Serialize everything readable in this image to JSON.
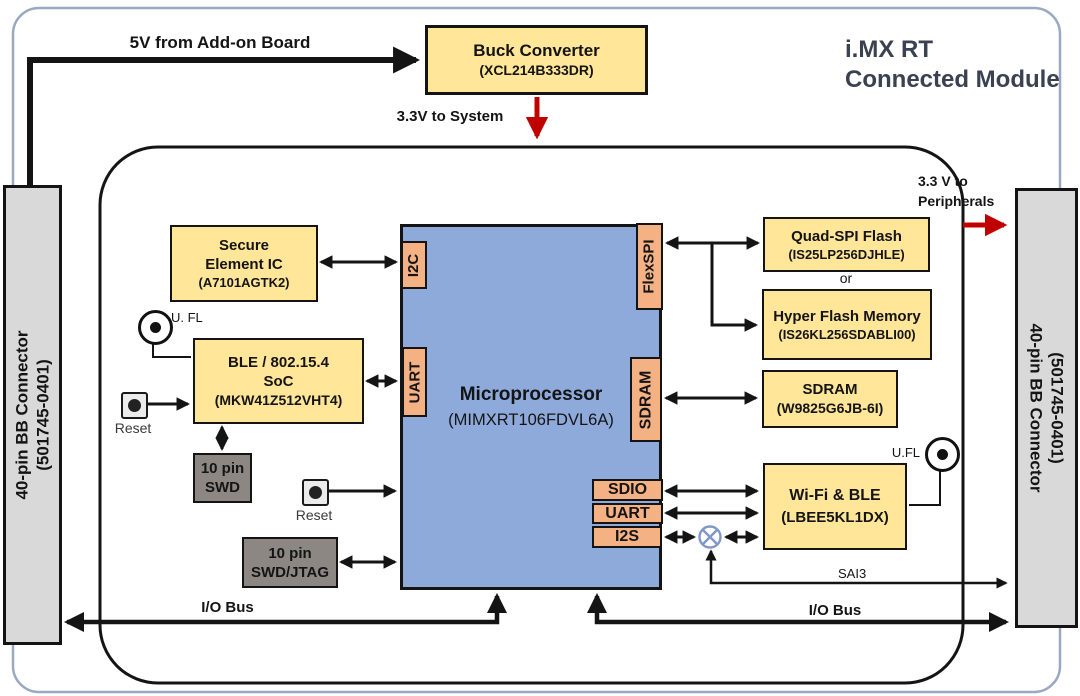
{
  "title": {
    "line1": "i.MX RT",
    "line2": "Connected Module"
  },
  "power": {
    "input_5v_label": "5V from Add-on Board",
    "buck_converter": {
      "name": "Buck Converter",
      "part": "(XCL214B333DR)"
    },
    "to_system_label": "3.3V to System",
    "to_peripherals": {
      "line1": "3.3 V to",
      "line2": "Peripherals"
    }
  },
  "connectors": {
    "left": {
      "name": "40-pin BB Connector",
      "part": "(501745-0401)"
    },
    "right": {
      "name": "40-pin BB Connector",
      "part": "(501745-0401)"
    }
  },
  "microprocessor": {
    "name": "Microprocessor",
    "part": "(MIMXRT106FDVL6A)",
    "ports": {
      "i2c": "I2C",
      "uart_ble": "UART",
      "flexspi": "FlexSPI",
      "sdram": "SDRAM",
      "sdio": "SDIO",
      "uart_wifi": "UART",
      "i2s": "I2S"
    }
  },
  "blocks": {
    "secure_element": {
      "line1": "Secure",
      "line2": "Element IC",
      "part": "(A7101AGTK2)"
    },
    "ble_soc": {
      "line1": "BLE / 802.15.4",
      "line2": "SoC",
      "part": "(MKW41Z512VHT4)"
    },
    "swd_header": {
      "line1": "10 pin",
      "line2": "SWD"
    },
    "swd_jtag_header": {
      "line1": "10 pin",
      "line2": "SWD/JTAG"
    },
    "quad_spi_flash": {
      "name": "Quad-SPI Flash",
      "part": "(IS25LP256DJHLE)"
    },
    "flash_or_label": "or",
    "hyper_flash": {
      "name": "Hyper Flash Memory",
      "part": "(IS26KL256SDABLI00)"
    },
    "sdram_chip": {
      "name": "SDRAM",
      "part": "(W9825G6JB-6I)"
    },
    "wifi_ble": {
      "name": "Wi-Fi & BLE",
      "part": "(LBEE5KL1DX)"
    }
  },
  "labels": {
    "reset_ble": "Reset",
    "reset_mcu": "Reset",
    "ufl_ble": "U. FL",
    "ufl_wifi": "U.FL",
    "sai3_bus": "SAI3",
    "io_bus_left": "I/O Bus",
    "io_bus_right": "I/O Bus"
  },
  "colors": {
    "block_yellow": "#FFE699",
    "mcu_blue": "#8EAADB",
    "port_orange": "#F4B183",
    "connector_gray": "#D9D9D9",
    "debug_gray": "#8C8782",
    "power_red": "#C00000",
    "line_black": "#141414",
    "frame_blue_gray": "#9AA9C2"
  }
}
